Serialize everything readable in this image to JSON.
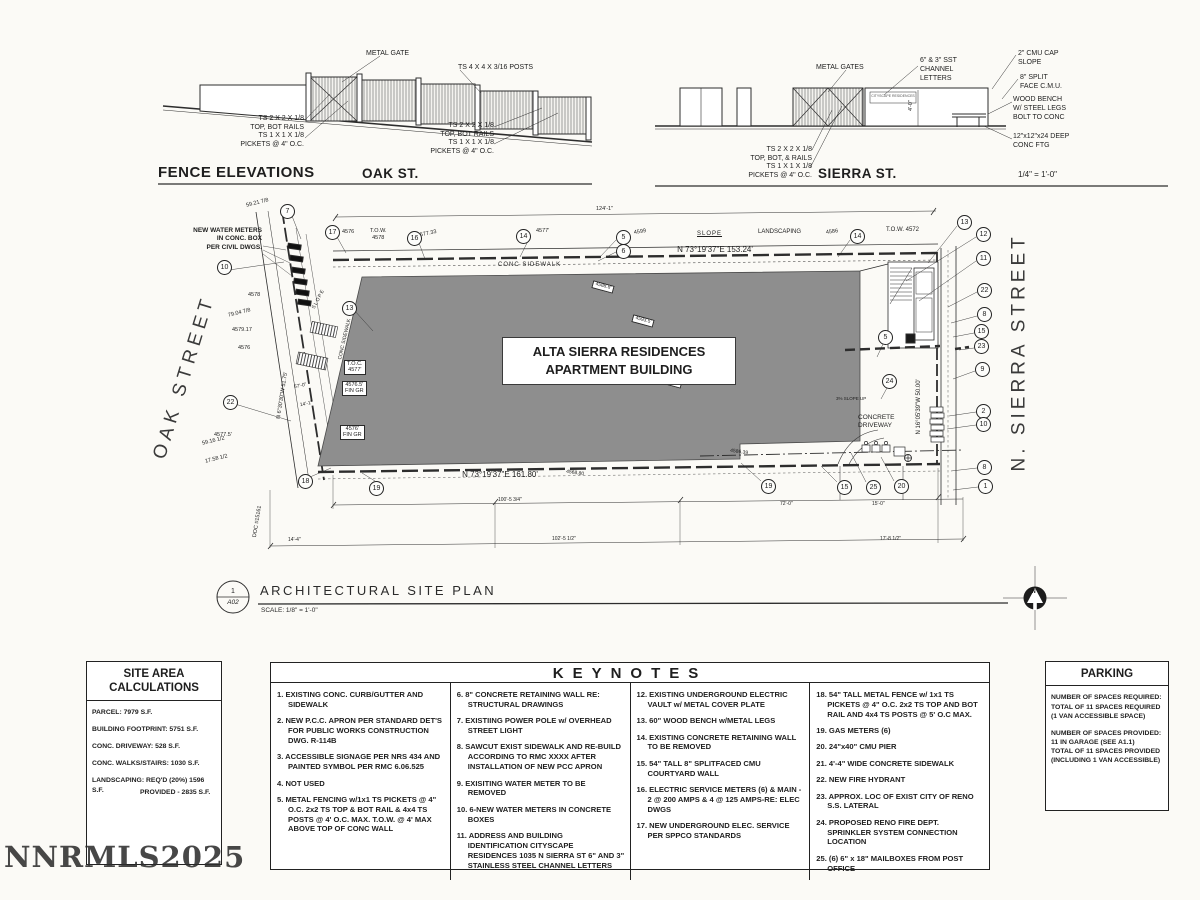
{
  "watermark": "NNRMLS2025",
  "fence": {
    "title": "FENCE  ELEVATIONS",
    "oak_label": "OAK ST.",
    "sierra_label": "SIERRA ST.",
    "scale_note": "1/4\" = 1'-0\"",
    "oak_notes": {
      "metal_gate": "METAL GATE",
      "posts": "TS 4 X 4 X 3/16 POSTS",
      "rails_left": "TS 2 X 2 X 1/8\nTOP, BOT RAILS",
      "pickets_left": "TS 1 X 1 X 1/8\nPICKETS @ 4\" O.C.",
      "rails_right": "TS 2 X 2 X 1/8\nTOP, BOT RAILS",
      "pickets_right": "TS 1 X 1 X 1/8\nPICKETS @ 4\" O.C."
    },
    "sierra_notes": {
      "metal_gates": "METAL GATES",
      "channel_letters": "6\" & 3\" SST\nCHANNEL\nLETTERS",
      "cmu_cap": "2\" CMU CAP\nSLOPE",
      "split_face": "8\" SPLIT\nFACE C.M.U.",
      "bench": "WOOD BENCH\nW/ STEEL LEGS\nBOLT TO CONC",
      "footing": "12\"x12\"x24 DEEP\nCONC FTG",
      "rails": "TS 2 X 2 X 1/8\nTOP, BOT, & RAILS",
      "pickets": "TS 1 X 1 X 1/8\nPICKETS @ 4\" O.C.",
      "sign_text": "CITYSCAPE RESIDENCES",
      "dim_4ft": "4'-0\""
    }
  },
  "plan": {
    "building_name": "ALTA SIERRA RESIDENCES",
    "building_type": "APARTMENT BUILDING",
    "oak_street": "OAK  STREET",
    "sierra_street": "N.  SIERRA  STREET",
    "bearing_top": "N 73°19'37\"E  153.24'",
    "bearing_bottom": "N 73°19'37\"E  161.80'",
    "bearing_left": "N 6°30'30\"W  51.75'",
    "bearing_right": "N 16°05'39\"W  50.00'",
    "water_meters": "NEW WATER METERS\nIN CONC. BOX\nPER CIVIL DWGS.",
    "conc_sidewalk": "CONC SIDEWALK",
    "conc_sidewalk_side": "CONC SIDEWALK",
    "slope_top": "SLOPE",
    "slope_side": "SLOPE",
    "slope_up": "3% SLOPE UP",
    "landscaping": "LANDSCAPING",
    "concrete_driveway": "CONCRETE\nDRIVEWAY",
    "tow_left": "T.O.W.\n4578",
    "tow_right": "T.O.W. 4572",
    "toc_box": "T.O.C.\n4577'",
    "fingr_box1": "4576.5'\nFIN GR",
    "fingr_box2": "4576'\nFIN GR",
    "elev_4576a": "4576",
    "elev_457733": "4577.33",
    "elev_4577": "4577'",
    "elev_4599": "4599",
    "elev_4586": "4586",
    "elev_457917": "4579.17",
    "elev_4576b": "4576",
    "elev_4578": "4578",
    "elev_45775": "4577.5'",
    "spot1": "4588.8'",
    "spot2": "4593.5'",
    "spot3": "4599.5'",
    "spot4": "4586.39",
    "spot5": "4568.80",
    "num_5921": "59.21 7/8",
    "num_7904": "79.04 7/8",
    "num_5916": "59.16 1/2",
    "num_1758": "17.58 1/2",
    "doc_note": "DOC #15161",
    "dim_124": "124'-1\"",
    "dim_102": "102'-5 1/2\"",
    "dim_100": "100'-5 3/4\"",
    "dim_72": "72'-0\"",
    "dim_15": "15'-0\"",
    "dim_17": "17'-8 1/2\"",
    "dim_57": "57'-0\"",
    "dim_14a": "14'-1\"",
    "dim_14b": "14'-4\"",
    "title": "ARCHITECTURAL  SITE  PLAN",
    "title_scale": "SCALE: 1/8\" = 1'-0\"",
    "detail_number": "1",
    "sheet_ref": "A02",
    "north_letter": "N",
    "bubbles": [
      "7",
      "17",
      "16",
      "14",
      "5",
      "6",
      "14",
      "13",
      "12",
      "11",
      "22",
      "8",
      "15",
      "23",
      "9",
      "5",
      "24",
      "13",
      "10",
      "22",
      "18",
      "19",
      "19",
      "15",
      "25",
      "20",
      "2",
      "10",
      "8",
      "1"
    ]
  },
  "site_area": {
    "title": "SITE AREA\nCALCULATIONS",
    "rows": [
      "PARCEL: 7979 S.F.",
      "BUILDING FOOTPRINT: 5751 S.F.",
      "CONC. DRIVEWAY: 528 S.F.",
      "CONC. WALKS/STAIRS: 1030 S.F.",
      "LANDSCAPING: REQ'D (20%) 1596 S.F.",
      "PROVIDED - 2835 S.F."
    ]
  },
  "keynotes": {
    "title": "KEYNOTES",
    "col1": [
      "1. EXISTING CONC. CURB/GUTTER AND SIDEWALK",
      "2. NEW P.C.C. APRON PER STANDARD DET'S FOR PUBLIC WORKS CONSTRUCTION DWG. R-114B",
      "3. ACCESSIBLE SIGNAGE PER NRS 434 AND PAINTED SYMBOL PER RMC 6.06.525",
      "4. NOT USED",
      "5. METAL FENCING w/1x1 TS PICKETS @ 4\" O.C. 2x2 TS TOP & BOT RAIL & 4x4 TS POSTS @ 4' O.C. MAX. T.O.W. @ 4' MAX ABOVE TOP OF CONC WALL"
    ],
    "col2": [
      "6. 8\" CONCRETE RETAINING WALL RE: STRUCTURAL DRAWINGS",
      "7. EXISTIING POWER POLE w/ OVERHEAD STREET LIGHT",
      "8. SAWCUT EXIST SIDEWALK AND RE-BUILD ACCORDING TO RMC XXXX AFTER INSTALLATION OF NEW PCC APRON",
      "9. EXISITING WATER METER TO BE REMOVED",
      "10. 6-NEW WATER METERS IN CONCRETE BOXES",
      "11. ADDRESS AND BUILDING IDENTIFICATION CITYSCAPE RESIDENCES 1035 N SIERRA ST 6\" AND 3\" STAINLESS STEEL CHANNEL LETTERS"
    ],
    "col3": [
      "12. EXISTING UNDERGROUND ELECTRIC VAULT w/ METAL COVER PLATE",
      "13. 60\" WOOD BENCH w/METAL LEGS",
      "14. EXISTING  CONCRETE  RETAINING WALL TO BE REMOVED",
      "15. 54\" TALL 8\" SPLITFACED CMU COURTYARD WALL",
      "16. ELECTRIC SERVICE METERS (6) & MAIN - 2 @ 200 AMPS & 4 @ 125 AMPS-RE: ELEC DWGS",
      "17. NEW UNDERGROUND ELEC. SERVICE PER SPPCO STANDARDS"
    ],
    "col4": [
      "18. 54\" TALL METAL FENCE w/ 1x1 TS PICKETS @ 4\" O.C. 2x2 TS TOP AND BOT RAIL AND 4x4 TS POSTS @ 5' O.C MAX.",
      "19. GAS METERS  (6)",
      "20. 24\"x40\" CMU PIER",
      "21. 4'-4\" WIDE CONCRETE SIDEWALK",
      "22. NEW FIRE HYDRANT",
      "23. APPROX. LOC OF EXIST CITY OF RENO S.S. LATERAL",
      "24. PROPOSED RENO FIRE DEPT. SPRINKLER SYSTEM CONNECTION LOCATION",
      "25. (6) 6\" x 18\" MAILBOXES FROM POST OFFICE"
    ]
  },
  "parking": {
    "title": "PARKING",
    "required": "NUMBER OF SPACES REQUIRED:\nTOTAL OF 11 SPACES REQUIRED\n(1 VAN ACCESSIBLE SPACE)",
    "provided": "NUMBER OF SPACES PROVIDED:\n11 IN GARAGE (SEE A1.1)\nTOTAL OF 11 SPACES PROVIDED\n(INCLUDING 1 VAN ACCESSIBLE)"
  }
}
